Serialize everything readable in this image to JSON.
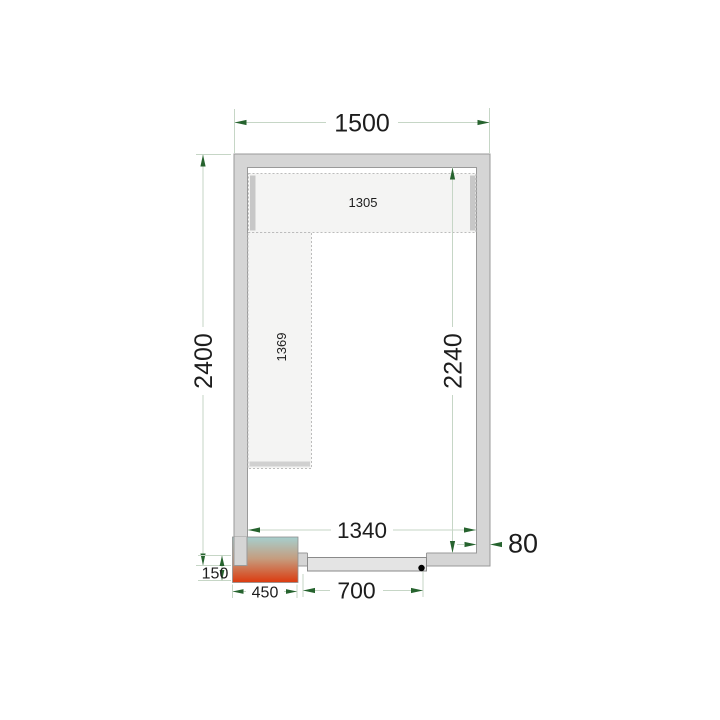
{
  "diagram": {
    "title": "Cold room floor plan with shelving, door and cooling unit",
    "dimension_labels": {
      "outer_width": "1500",
      "outer_height": "2400",
      "inner_height": "2240",
      "inner_width": "1340",
      "door_width": "700",
      "unit_width": "450",
      "unit_protrusion": "150",
      "wall_thickness": "80",
      "shelf_top_length": "1305",
      "shelf_left_length": "1369"
    },
    "colors": {
      "wall_fill": "#d5d5d5",
      "wall_stroke": "#999999",
      "shelf_fill": "#f4f4f3",
      "shelf_stroke": "#bcbcbc",
      "shelf_leg": "#c7c7c7",
      "dim_line": "#c6d6c6",
      "dim_arrow": "#26632e",
      "dim_text": "#1d1d1d",
      "door_fill": "#e4e4e4",
      "door_stroke": "#8a8a8a",
      "hinge_dot": "#000000",
      "unit_gradient_top": "#a6cfce",
      "unit_gradient_mid": "#c59c7e",
      "unit_gradient_bottom": "#dc3a0e"
    }
  }
}
